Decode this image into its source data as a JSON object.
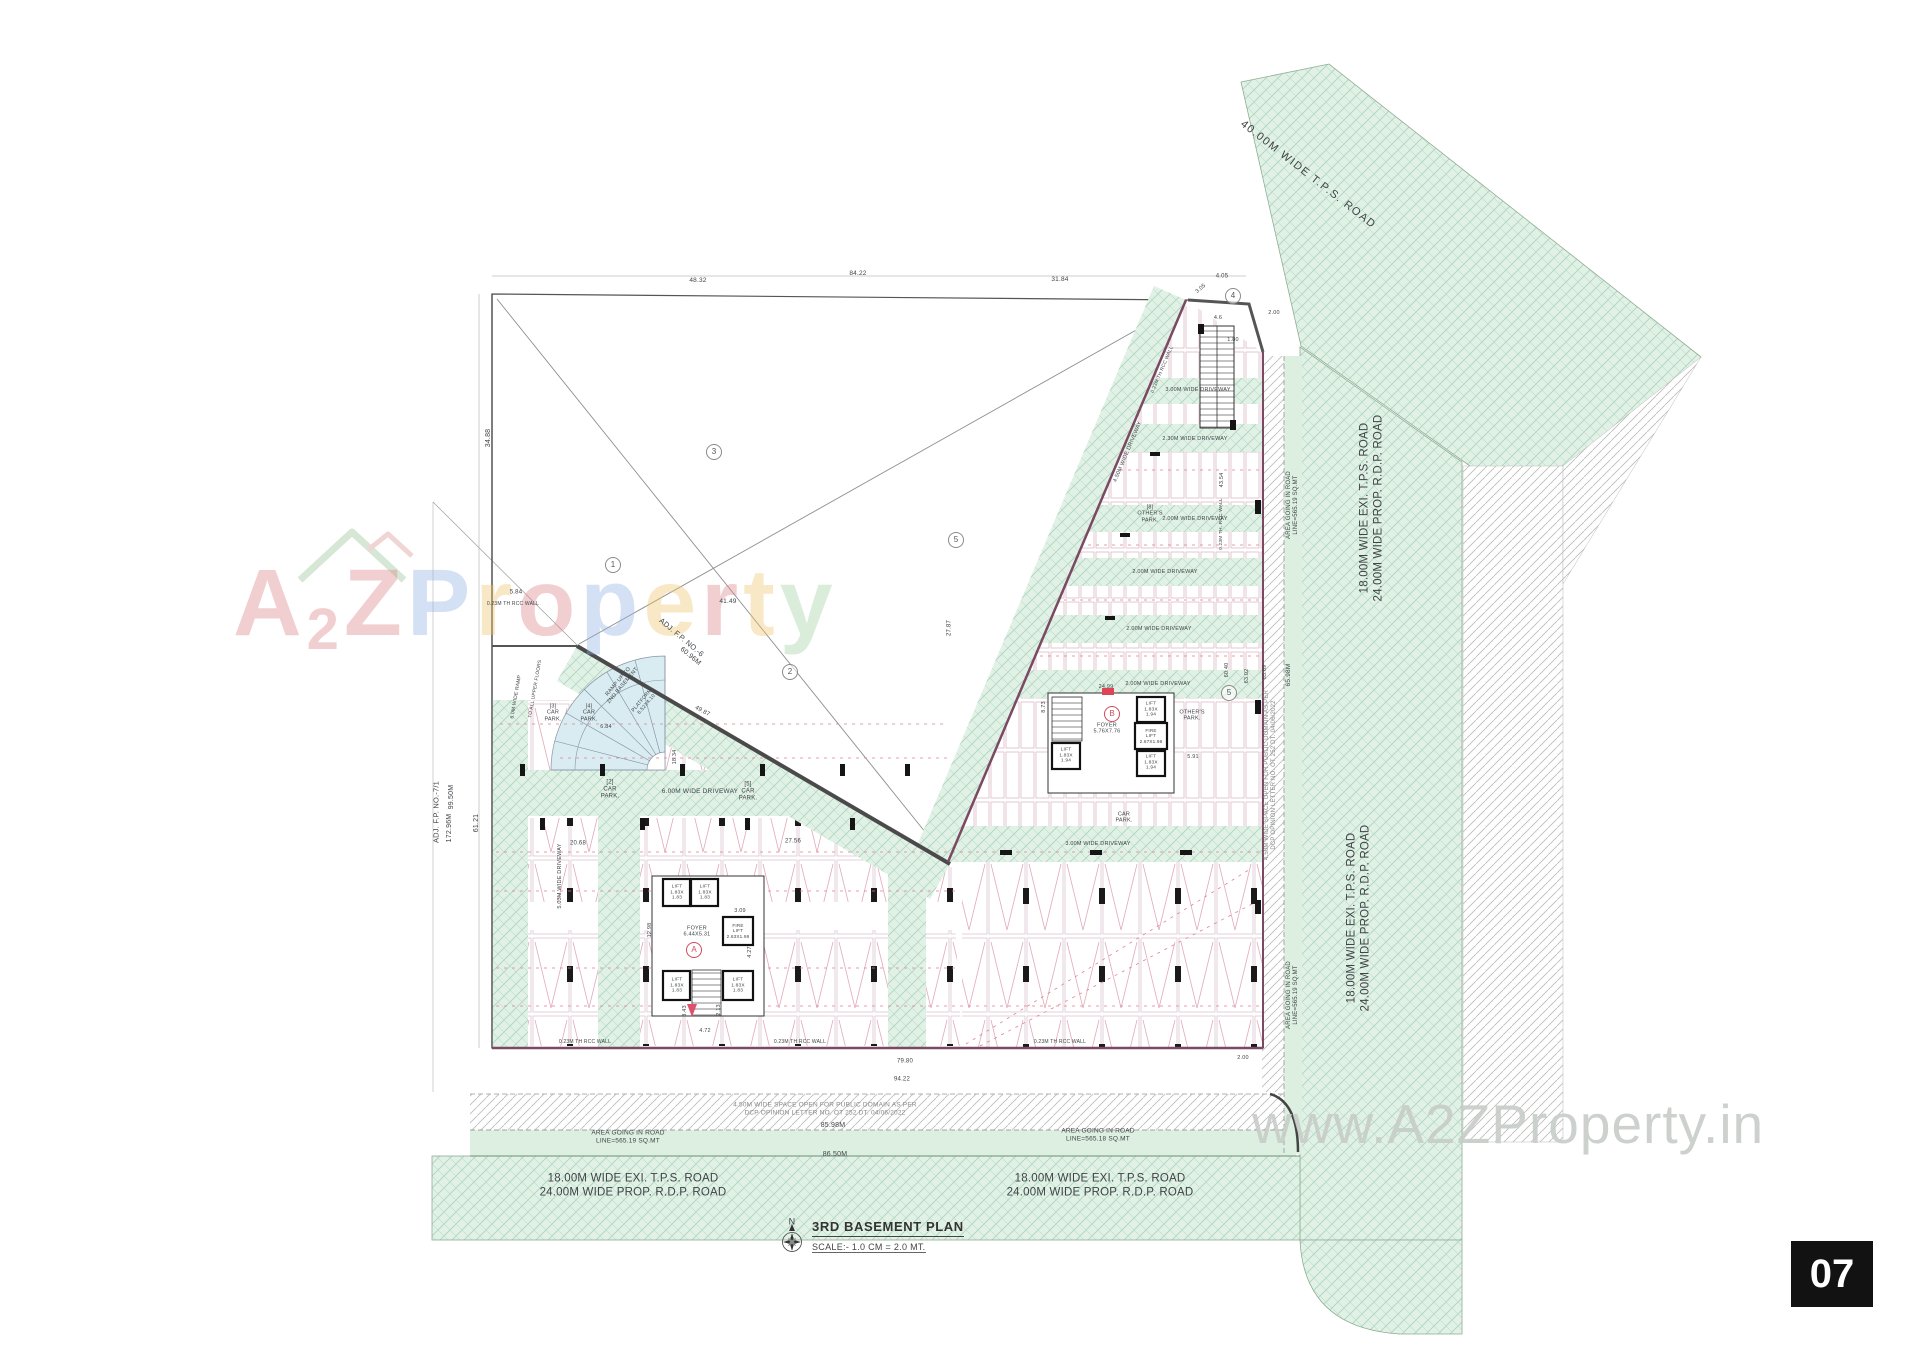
{
  "title_block": {
    "north_letter": "N",
    "title": "3RD BASEMENT PLAN",
    "scale": "SCALE:- 1.0 CM = 2.0 MT."
  },
  "page_number": "07",
  "watermark": {
    "url": "www.A2ZProperty.in",
    "letters": [
      {
        "ch": "A",
        "c": "#db8289"
      },
      {
        "ch": "2",
        "c": "#db8289",
        "small": true
      },
      {
        "ch": "Z",
        "c": "#db8289"
      },
      {
        "ch": "P",
        "c": "#8fb0e2"
      },
      {
        "ch": "r",
        "c": "#f0c468"
      },
      {
        "ch": "o",
        "c": "#db8289"
      },
      {
        "ch": "p",
        "c": "#8fb0e2"
      },
      {
        "ch": "e",
        "c": "#f0c468"
      },
      {
        "ch": "r",
        "c": "#db8289"
      },
      {
        "ch": "t",
        "c": "#f0c468"
      },
      {
        "ch": "y",
        "c": "#9fcf9f"
      }
    ]
  },
  "colors": {
    "road_hatch": "#a8d4bc",
    "road_bg": "#e2f1e6",
    "wall_pink": "#7a4a62",
    "dash_red": "#e08090",
    "accent_red": "#d04a5c"
  },
  "markers": [
    {
      "t": "A",
      "x": 694,
      "y": 950,
      "red": true
    },
    {
      "t": "B",
      "x": 1112,
      "y": 714,
      "red": true
    },
    {
      "t": "1",
      "x": 613,
      "y": 565
    },
    {
      "t": "2",
      "x": 790,
      "y": 672
    },
    {
      "t": "3",
      "x": 714,
      "y": 452
    },
    {
      "t": "5",
      "x": 956,
      "y": 540
    },
    {
      "t": "4",
      "x": 1233,
      "y": 296
    },
    {
      "t": "5",
      "x": 1229,
      "y": 693
    }
  ],
  "labels": [
    {
      "n": "road-label-40m",
      "t": "40.00M WIDE T.P.S. ROAD",
      "x": 1308,
      "y": 175,
      "r": 38,
      "s": 11,
      "ls": 1.5
    },
    {
      "n": "road-label-right-upper",
      "t": "18.00M WIDE EXI. T.P.S. ROAD\n24.00M WIDE PROP. R.D.P. ROAD",
      "x": 1372,
      "y": 508,
      "r": -90,
      "s": 11.5
    },
    {
      "n": "road-label-right-lower",
      "t": "18.00M WIDE EXI. T.P.S. ROAD\n24.00M WIDE PROP. R.D.P. ROAD",
      "x": 1359,
      "y": 918,
      "r": -90,
      "s": 11.5
    },
    {
      "n": "road-label-bottom-left",
      "t": "18.00M WIDE EXI. T.P.S. ROAD\n24.00M WIDE PROP. R.D.P. ROAD",
      "x": 633,
      "y": 1186,
      "s": 11.5
    },
    {
      "n": "road-label-bottom-right",
      "t": "18.00M WIDE EXI. T.P.S. ROAD\n24.00M WIDE PROP. R.D.P. ROAD",
      "x": 1100,
      "y": 1186,
      "s": 11.5
    },
    {
      "n": "public-strip-bottom",
      "t": "4.50M WIDE SPACE OPEN FOR PUBLIC DOMAIN AS PER\nDCP OPINION LETTER NO. OT 252 DT. 04/06/2022",
      "x": 825,
      "y": 1109,
      "s": 6.5,
      "c": "#86888a"
    },
    {
      "n": "area-going-road-left",
      "t": "AREA GOING IN ROAD\nLINE=565.19 SQ.MT",
      "x": 628,
      "y": 1137,
      "s": 6.5
    },
    {
      "n": "area-going-road-right",
      "t": "AREA GOING IN ROAD\nLINE=565.18 SQ.MT",
      "x": 1098,
      "y": 1135,
      "s": 6.5
    },
    {
      "n": "dim-8598",
      "t": "85.98M",
      "x": 833,
      "y": 1126,
      "s": 7
    },
    {
      "n": "dim-8650",
      "t": "86.50M",
      "x": 835,
      "y": 1155,
      "s": 7
    },
    {
      "n": "area-going-road-side-upper",
      "t": "AREA GOING IN ROAD\nLINE=565.19 SQ.MT",
      "x": 1293,
      "y": 505,
      "r": -90,
      "s": 6
    },
    {
      "n": "area-going-road-side-lower",
      "t": "AREA GOING IN ROAD\nLINE=565.19 SQ.MT",
      "x": 1293,
      "y": 995,
      "r": -90,
      "s": 6
    },
    {
      "n": "public-strip-right",
      "t": "4.50M WIDE SPACE OPEN FOR PUBLIC DOMAIN AS PER\nDCP OPINION LETTER NO. OT 252 DT. 04/06/2022",
      "x": 1271,
      "y": 775,
      "r": -90,
      "s": 6,
      "c": "#86888a"
    },
    {
      "n": "dim-6598m",
      "t": "65.98M",
      "x": 1289,
      "y": 675,
      "r": -90,
      "s": 6.5
    },
    {
      "n": "adj-fp-71",
      "t": "ADJ. F.P. NO.-7/1",
      "x": 437,
      "y": 812,
      "r": -90,
      "s": 7.5
    },
    {
      "n": "dim-9950m",
      "t": "99.50M",
      "x": 452,
      "y": 797,
      "r": -90,
      "s": 7
    },
    {
      "n": "dim-17296m",
      "t": "172.96M",
      "x": 450,
      "y": 828,
      "r": -90,
      "s": 7
    },
    {
      "n": "dim-6121",
      "t": "61.21",
      "x": 477,
      "y": 823,
      "r": -90,
      "s": 7
    },
    {
      "n": "dim-3488",
      "t": "34.88",
      "x": 489,
      "y": 438,
      "r": -90,
      "s": 7
    },
    {
      "n": "adj-fp-6",
      "t": "ADJ. F.P. NO.-6",
      "x": 681,
      "y": 638,
      "r": 40,
      "s": 7.5
    },
    {
      "n": "dim-6096m",
      "t": "60.96M",
      "x": 690,
      "y": 657,
      "r": 40,
      "s": 7
    },
    {
      "n": "dim-4149",
      "t": "41.49",
      "x": 728,
      "y": 602,
      "s": 6.5
    },
    {
      "n": "dim-584",
      "t": "5.84",
      "x": 516,
      "y": 593,
      "s": 6
    },
    {
      "n": "wall-note",
      "t": "0.23M TH RCC WALL",
      "x": 513,
      "y": 605,
      "s": 5
    },
    {
      "n": "dim-8422",
      "t": "84.22",
      "x": 858,
      "y": 274,
      "s": 6.5
    },
    {
      "n": "dim-4832",
      "t": "48.32",
      "x": 698,
      "y": 281,
      "s": 6.5
    },
    {
      "n": "dim-3184",
      "t": "31.84",
      "x": 1060,
      "y": 280,
      "s": 6.5
    },
    {
      "n": "dim-405",
      "t": "4.05",
      "x": 1222,
      "y": 277,
      "s": 6
    },
    {
      "n": "dim-305",
      "t": "3.05",
      "x": 1201,
      "y": 289,
      "r": -40,
      "s": 5.5
    },
    {
      "n": "dim-46",
      "t": "4.6",
      "x": 1218,
      "y": 318,
      "s": 5.5
    },
    {
      "n": "dim-180",
      "t": "1.80",
      "x": 1233,
      "y": 340,
      "s": 5.5
    },
    {
      "n": "dim-200a",
      "t": "2.00",
      "x": 1274,
      "y": 313,
      "s": 5.5
    },
    {
      "n": "carpark-3",
      "t": "[3]\nCAR\nPARK.",
      "x": 553,
      "y": 713,
      "s": 5.5
    },
    {
      "n": "carpark-4",
      "t": "[4]\nCAR\nPARK.",
      "x": 589,
      "y": 713,
      "s": 5.5
    },
    {
      "n": "dim-684",
      "t": "6.84",
      "x": 606,
      "y": 727,
      "s": 5.5
    },
    {
      "n": "dim-4987",
      "t": "49.87",
      "x": 702,
      "y": 712,
      "r": 28,
      "s": 6
    },
    {
      "n": "carpark-2",
      "t": "[2]\nCAR\nPARK.",
      "x": 610,
      "y": 790,
      "s": 6
    },
    {
      "n": "driveway-600m",
      "t": "6.00M WIDE DRIVEWAY",
      "x": 700,
      "y": 792,
      "s": 6.5
    },
    {
      "n": "carpark-5",
      "t": "[5]\nCAR\nPARK.",
      "x": 748,
      "y": 792,
      "s": 6
    },
    {
      "n": "dim-1834",
      "t": "18.34",
      "x": 675,
      "y": 757,
      "r": -90,
      "s": 5.5
    },
    {
      "n": "dim-2068",
      "t": "20.68",
      "x": 578,
      "y": 844,
      "s": 6
    },
    {
      "n": "dim-2756",
      "t": "27.56",
      "x": 793,
      "y": 842,
      "s": 6
    },
    {
      "n": "driveway-503m",
      "t": "5.03M WIDE DRIVEWAY",
      "x": 560,
      "y": 876,
      "r": -90,
      "s": 5.5
    },
    {
      "n": "dim-1298",
      "t": "12.98",
      "x": 650,
      "y": 930,
      "r": -90,
      "s": 5.5
    },
    {
      "n": "dim-309",
      "t": "3.09",
      "x": 740,
      "y": 911,
      "s": 5.5
    },
    {
      "n": "dim-427",
      "t": "4.27",
      "x": 750,
      "y": 952,
      "r": -90,
      "s": 5.5
    },
    {
      "n": "foyer-a",
      "t": "FOYER\n6.44X5.31",
      "x": 697,
      "y": 932,
      "s": 5.5
    },
    {
      "n": "dim-472",
      "t": "4.72",
      "x": 705,
      "y": 1031,
      "s": 5.5
    },
    {
      "n": "dim-343",
      "t": "3.43",
      "x": 685,
      "y": 1011,
      "r": -90,
      "s": 5.5
    },
    {
      "n": "dim-213",
      "t": "2.13",
      "x": 719,
      "y": 1010,
      "r": -90,
      "s": 5.5
    },
    {
      "n": "wall-note",
      "t": "0.23M TH RCC WALL",
      "x": 585,
      "y": 1043,
      "s": 5
    },
    {
      "n": "wall-note",
      "t": "0.23M TH RCC WALL",
      "x": 800,
      "y": 1043,
      "s": 5
    },
    {
      "n": "wall-note",
      "t": "0.23M TH RCC WALL",
      "x": 1060,
      "y": 1043,
      "s": 5
    },
    {
      "n": "dim-7980",
      "t": "79.80",
      "x": 905,
      "y": 1062,
      "s": 6
    },
    {
      "n": "dim-9422",
      "t": "94.22",
      "x": 902,
      "y": 1080,
      "s": 6
    },
    {
      "n": "dim-200b",
      "t": "2.00",
      "x": 1243,
      "y": 1058,
      "s": 5.5
    },
    {
      "n": "ramp-note",
      "t": "RAMP UP TO\n2ND BASEMENT",
      "x": 621,
      "y": 684,
      "r": -50,
      "s": 5.5
    },
    {
      "n": "platform-note",
      "t": "PLATFORM\n6.52X4.10",
      "x": 645,
      "y": 703,
      "r": -50,
      "s": 5
    },
    {
      "n": "ramp-width-note",
      "t": "6.0M WIDE RAMP",
      "x": 517,
      "y": 697,
      "r": -80,
      "s": 5
    },
    {
      "n": "ramp-upper-note",
      "t": "TO ALL UPPER FLOORS",
      "x": 536,
      "y": 689,
      "r": -80,
      "s": 4.8
    },
    {
      "n": "driveway-300m-top",
      "t": "3.00M WIDE DRIVEWAY",
      "x": 1198,
      "y": 390,
      "s": 5.5
    },
    {
      "n": "driveway-230m",
      "t": "2.30M WIDE DRIVEWAY",
      "x": 1195,
      "y": 439,
      "s": 5.5
    },
    {
      "n": "driveway-200m-1",
      "t": "2.00M WIDE DRIVEWAY",
      "x": 1195,
      "y": 519,
      "s": 5.5
    },
    {
      "n": "driveway-200m-2",
      "t": "2.00M WIDE DRIVEWAY",
      "x": 1165,
      "y": 572,
      "s": 5.5
    },
    {
      "n": "driveway-200m-3",
      "t": "2.00M WIDE DRIVEWAY",
      "x": 1159,
      "y": 629,
      "s": 5.5
    },
    {
      "n": "driveway-200m-4",
      "t": "2.00M WIDE DRIVEWAY",
      "x": 1158,
      "y": 684,
      "s": 5.5
    },
    {
      "n": "driveway-300m-bottom",
      "t": "3.00M WIDE DRIVEWAY",
      "x": 1098,
      "y": 844,
      "s": 5.5
    },
    {
      "n": "driveway-450m",
      "t": "4.50M WIDE DRIVEWAY",
      "x": 1128,
      "y": 452,
      "r": -67,
      "s": 5.5
    },
    {
      "n": "wall-note",
      "t": "0.23M TH RCC WALL",
      "x": 1163,
      "y": 370,
      "r": -67,
      "s": 4.8
    },
    {
      "n": "others-park-8",
      "t": "[8]\nOTHER'S\nPARK.",
      "x": 1150,
      "y": 514,
      "s": 5.5
    },
    {
      "n": "others-park",
      "t": "OTHER'S\nPARK.",
      "x": 1192,
      "y": 716,
      "s": 5.5
    },
    {
      "n": "dim-4354",
      "t": "43.54",
      "x": 1222,
      "y": 480,
      "r": -90,
      "s": 5.5
    },
    {
      "n": "wall-note",
      "t": "0.23M TH. RCC WALL",
      "x": 1222,
      "y": 524,
      "r": -90,
      "s": 4.8
    },
    {
      "n": "dim-2499",
      "t": "24.99",
      "x": 1106,
      "y": 687,
      "s": 5.5
    },
    {
      "n": "dim-873",
      "t": "8.73",
      "x": 1044,
      "y": 707,
      "r": -90,
      "s": 5.5
    },
    {
      "n": "dim-591",
      "t": "5.91",
      "x": 1193,
      "y": 757,
      "s": 5.5
    },
    {
      "n": "foyer-b",
      "t": "FOYER\n5.76X7.76",
      "x": 1107,
      "y": 729,
      "s": 5.5
    },
    {
      "n": "dim-2787",
      "t": "27.87",
      "x": 950,
      "y": 628,
      "r": -90,
      "s": 6
    },
    {
      "n": "dim-6040",
      "t": "60.40",
      "x": 1227,
      "y": 670,
      "r": -90,
      "s": 5.5
    },
    {
      "n": "dim-6302",
      "t": "63.02",
      "x": 1247,
      "y": 676,
      "r": -90,
      "s": 5.5
    },
    {
      "n": "dim-6569",
      "t": "65.69",
      "x": 1265,
      "y": 672,
      "r": -90,
      "s": 5.5
    },
    {
      "n": "carpark-right",
      "t": "CAR\nPARK.",
      "x": 1124,
      "y": 818,
      "s": 5.5
    },
    {
      "n": "lift-a1",
      "t": "LIFT\n1.83X\n1.83",
      "x": 677,
      "y": 893,
      "s": 4.8
    },
    {
      "n": "lift-a2",
      "t": "LIFT\n1.83X\n1.83",
      "x": 705,
      "y": 893,
      "s": 4.8
    },
    {
      "n": "firelift-a",
      "t": "FIRE\nLIFT\n2.63X1.98",
      "x": 738,
      "y": 931,
      "s": 4.6
    },
    {
      "n": "lift-a3",
      "t": "LIFT\n1.83X\n1.83",
      "x": 677,
      "y": 986,
      "s": 4.8
    },
    {
      "n": "lift-a4",
      "t": "LIFT\n1.83X\n1.83",
      "x": 738,
      "y": 986,
      "s": 4.8
    },
    {
      "n": "lift-b1",
      "t": "LIFT\n1.83X\n1.94",
      "x": 1066,
      "y": 756,
      "s": 4.8
    },
    {
      "n": "lift-b2",
      "t": "LIFT\n1.83X\n1.94",
      "x": 1151,
      "y": 710,
      "s": 4.8
    },
    {
      "n": "firelift-b",
      "t": "FIRE\nLIFT\n2.67X1.98",
      "x": 1151,
      "y": 736,
      "s": 4.6
    },
    {
      "n": "lift-b3",
      "t": "LIFT\n1.83X\n1.94",
      "x": 1151,
      "y": 763,
      "s": 4.8
    },
    {
      "n": "north-letter",
      "t": "N",
      "x": 792,
      "y": 1222,
      "s": 9
    }
  ]
}
